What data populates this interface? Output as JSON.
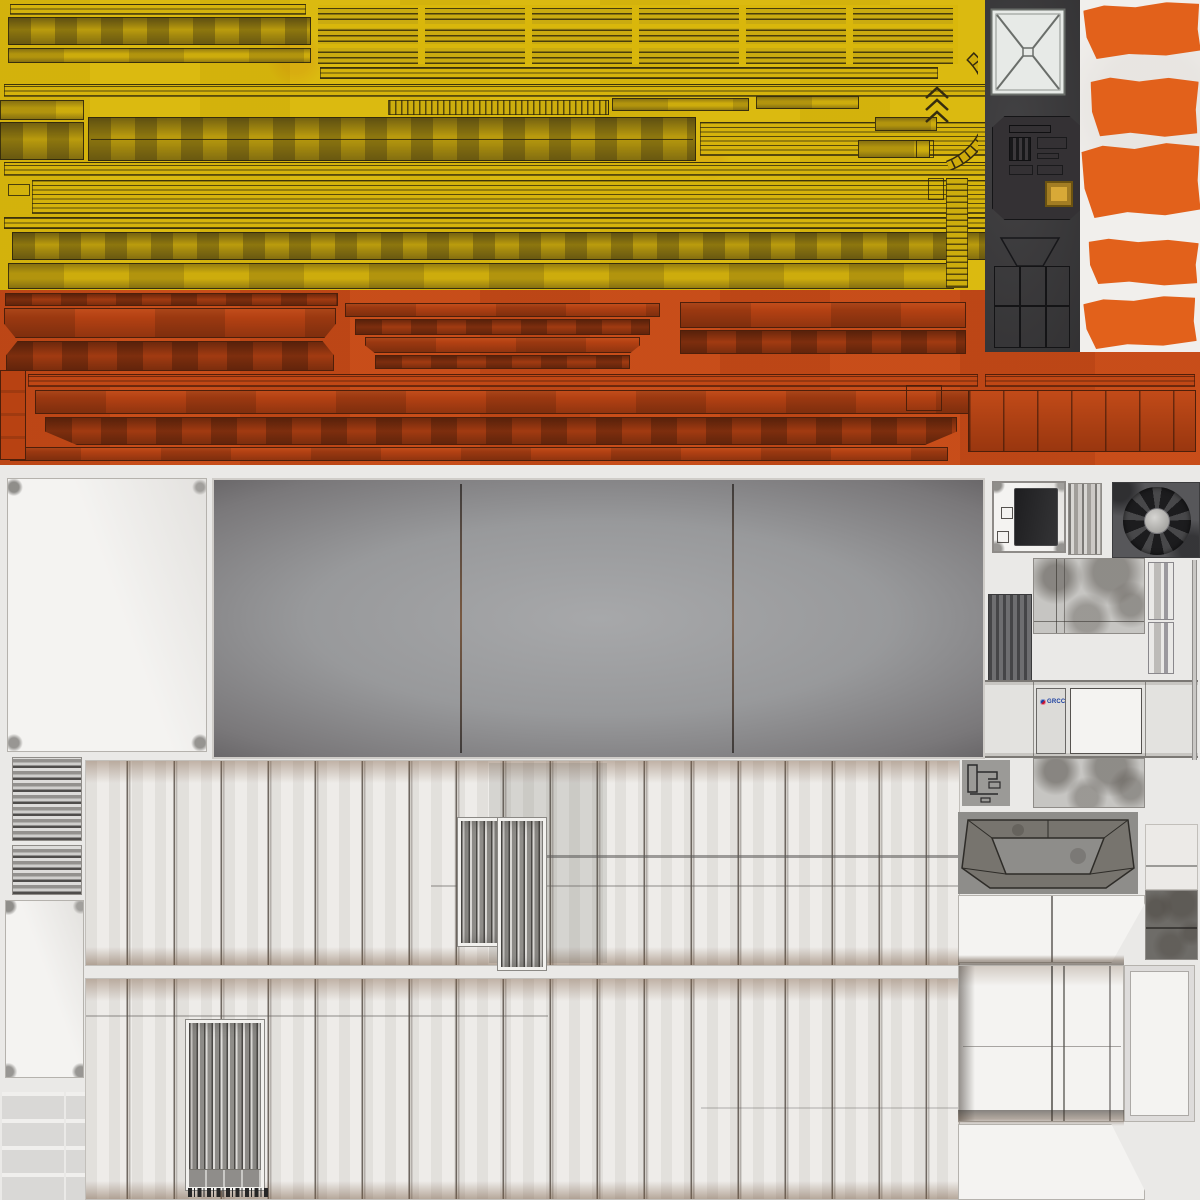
{
  "document": {
    "title": "PBR texture atlas sheet — industrial crane / warehouse model",
    "type": "uv-texture-atlas"
  },
  "labels": {
    "logo_text": "GRCC"
  },
  "palette": {
    "plank_yellow": "#d9b70b",
    "plank_outline": "#2a230c",
    "beam_orange": "#c54a17",
    "beam_outline": "#4e1f0a",
    "cab_panel_dark": "#3b3a3c",
    "hazard_white": "#f1efec",
    "hazard_orange": "#e2611b",
    "sheet_background": "#eae9e7",
    "concrete_white": "#f4f3f1",
    "roof_gray_center": "#a7a8aa",
    "roof_gray_edge": "#3f3c3e",
    "wall_light": "#eceae7",
    "rust_stain": "#8a6a52",
    "door_metal": "#b5b4b1",
    "fan_housing": "#57575a",
    "button_gold": "#d8a937",
    "logo_blue": "#1b3fa0",
    "logo_red": "#c8102e"
  },
  "icons": {
    "fan": "radial-fan-icon",
    "skylight": "x-brace-skylight-icon",
    "chevrons": "chevron-arrows-icon",
    "arc": "curved-rail-icon",
    "button": "gold-button-icon",
    "logo": "grcc-logo-icon"
  },
  "regions": [
    {
      "name": "yellow-plank-block",
      "description": "yellow painted crane boom planks, many horizontal strips"
    },
    {
      "name": "slat-grid",
      "description": "grid of slatted yellow vent blocks, 3 rows x 6 columns"
    },
    {
      "name": "orange-beam-block",
      "description": "orange chamfered I-beam strips"
    },
    {
      "name": "cab-panel",
      "description": "dark operator cab with skylight, control octagon, gold button"
    },
    {
      "name": "hazard-stripe-column",
      "description": "5 orange stripes on white crane leg"
    },
    {
      "name": "white-concrete-panel",
      "description": "blank white concrete slab"
    },
    {
      "name": "roof-panel",
      "description": "large dark mottled roof slab with two seams"
    },
    {
      "name": "wall-strip-upper",
      "description": "white pilastered wall with corrugated door inset"
    },
    {
      "name": "wall-strip-lower",
      "description": "white pilastered wall with roller door and glyph row"
    },
    {
      "name": "striped-blocks",
      "description": "horizontal grayscale striped blocks"
    },
    {
      "name": "cell-grid",
      "description": "small gray rectangles, two columns x four rows"
    },
    {
      "name": "fan-unit",
      "description": "dark radiator fan with 9 blades and light hub"
    },
    {
      "name": "box-unwrap-cross",
      "description": "cross-shaped unwrapped box with GRCC door decal and window"
    },
    {
      "name": "tunnel-trapezoid",
      "description": "unwrapped hopper / tunnel entrance frame"
    },
    {
      "name": "large-box-unwrap",
      "description": "bottom-right unwrapped white box with slanted flaps"
    }
  ]
}
